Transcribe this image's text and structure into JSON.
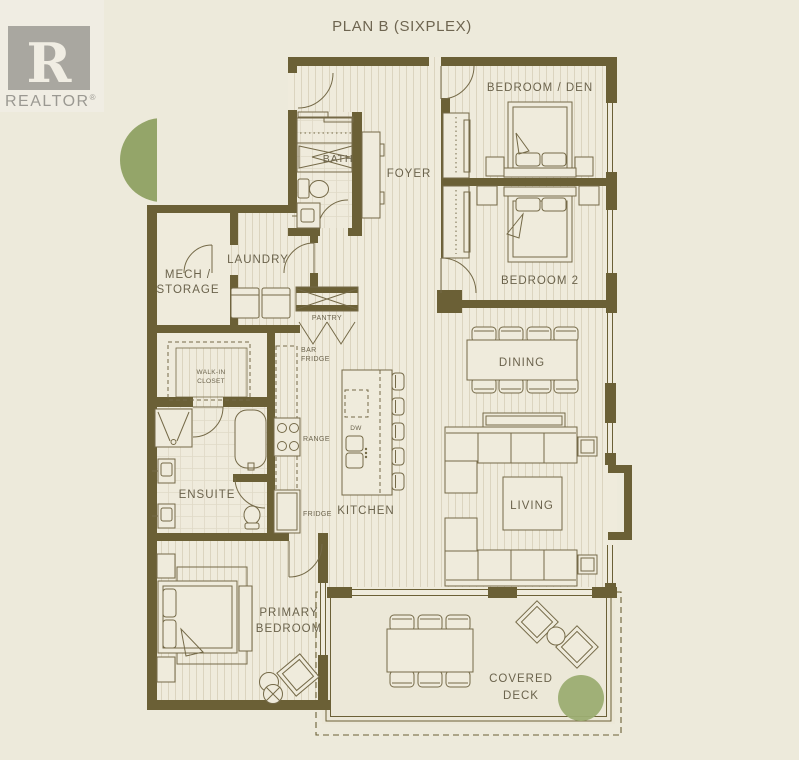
{
  "title": "PLAN B (SIXPLEX)",
  "logo": {
    "mark": "R",
    "word": "REALTOR",
    "reg": "®"
  },
  "rooms": {
    "bedroom_den": "BEDROOM / DEN",
    "bedroom2": "BEDROOM 2",
    "foyer": "FOYER",
    "bath": "BATH",
    "laundry": "LAUNDRY",
    "mech_line1": "MECH /",
    "mech_line2": "STORAGE",
    "pantry": "PANTRY",
    "dining": "DINING",
    "kitchen": "KITCHEN",
    "living": "LIVING",
    "ensuite": "ENSUITE",
    "walkin_line1": "WALK-IN",
    "walkin_line2": "CLOSET",
    "primary_line1": "PRIMARY",
    "primary_line2": "BEDROOM",
    "deck_line1": "COVERED",
    "deck_line2": "DECK"
  },
  "appliances": {
    "bar_fridge_line1": "BAR",
    "bar_fridge_line2": "FRIDGE",
    "range": "RANGE",
    "fridge": "FRIDGE",
    "dw": "DW"
  },
  "colors": {
    "background": "#EDEADB",
    "wall": "#6B6036",
    "furniture_line": "#756A48",
    "label_text": "#6B634C",
    "tree": "#8FA163",
    "tree_light": "#ACB77F",
    "shrub": "#9CAD72",
    "logo_gray": "#A9A7A0"
  }
}
